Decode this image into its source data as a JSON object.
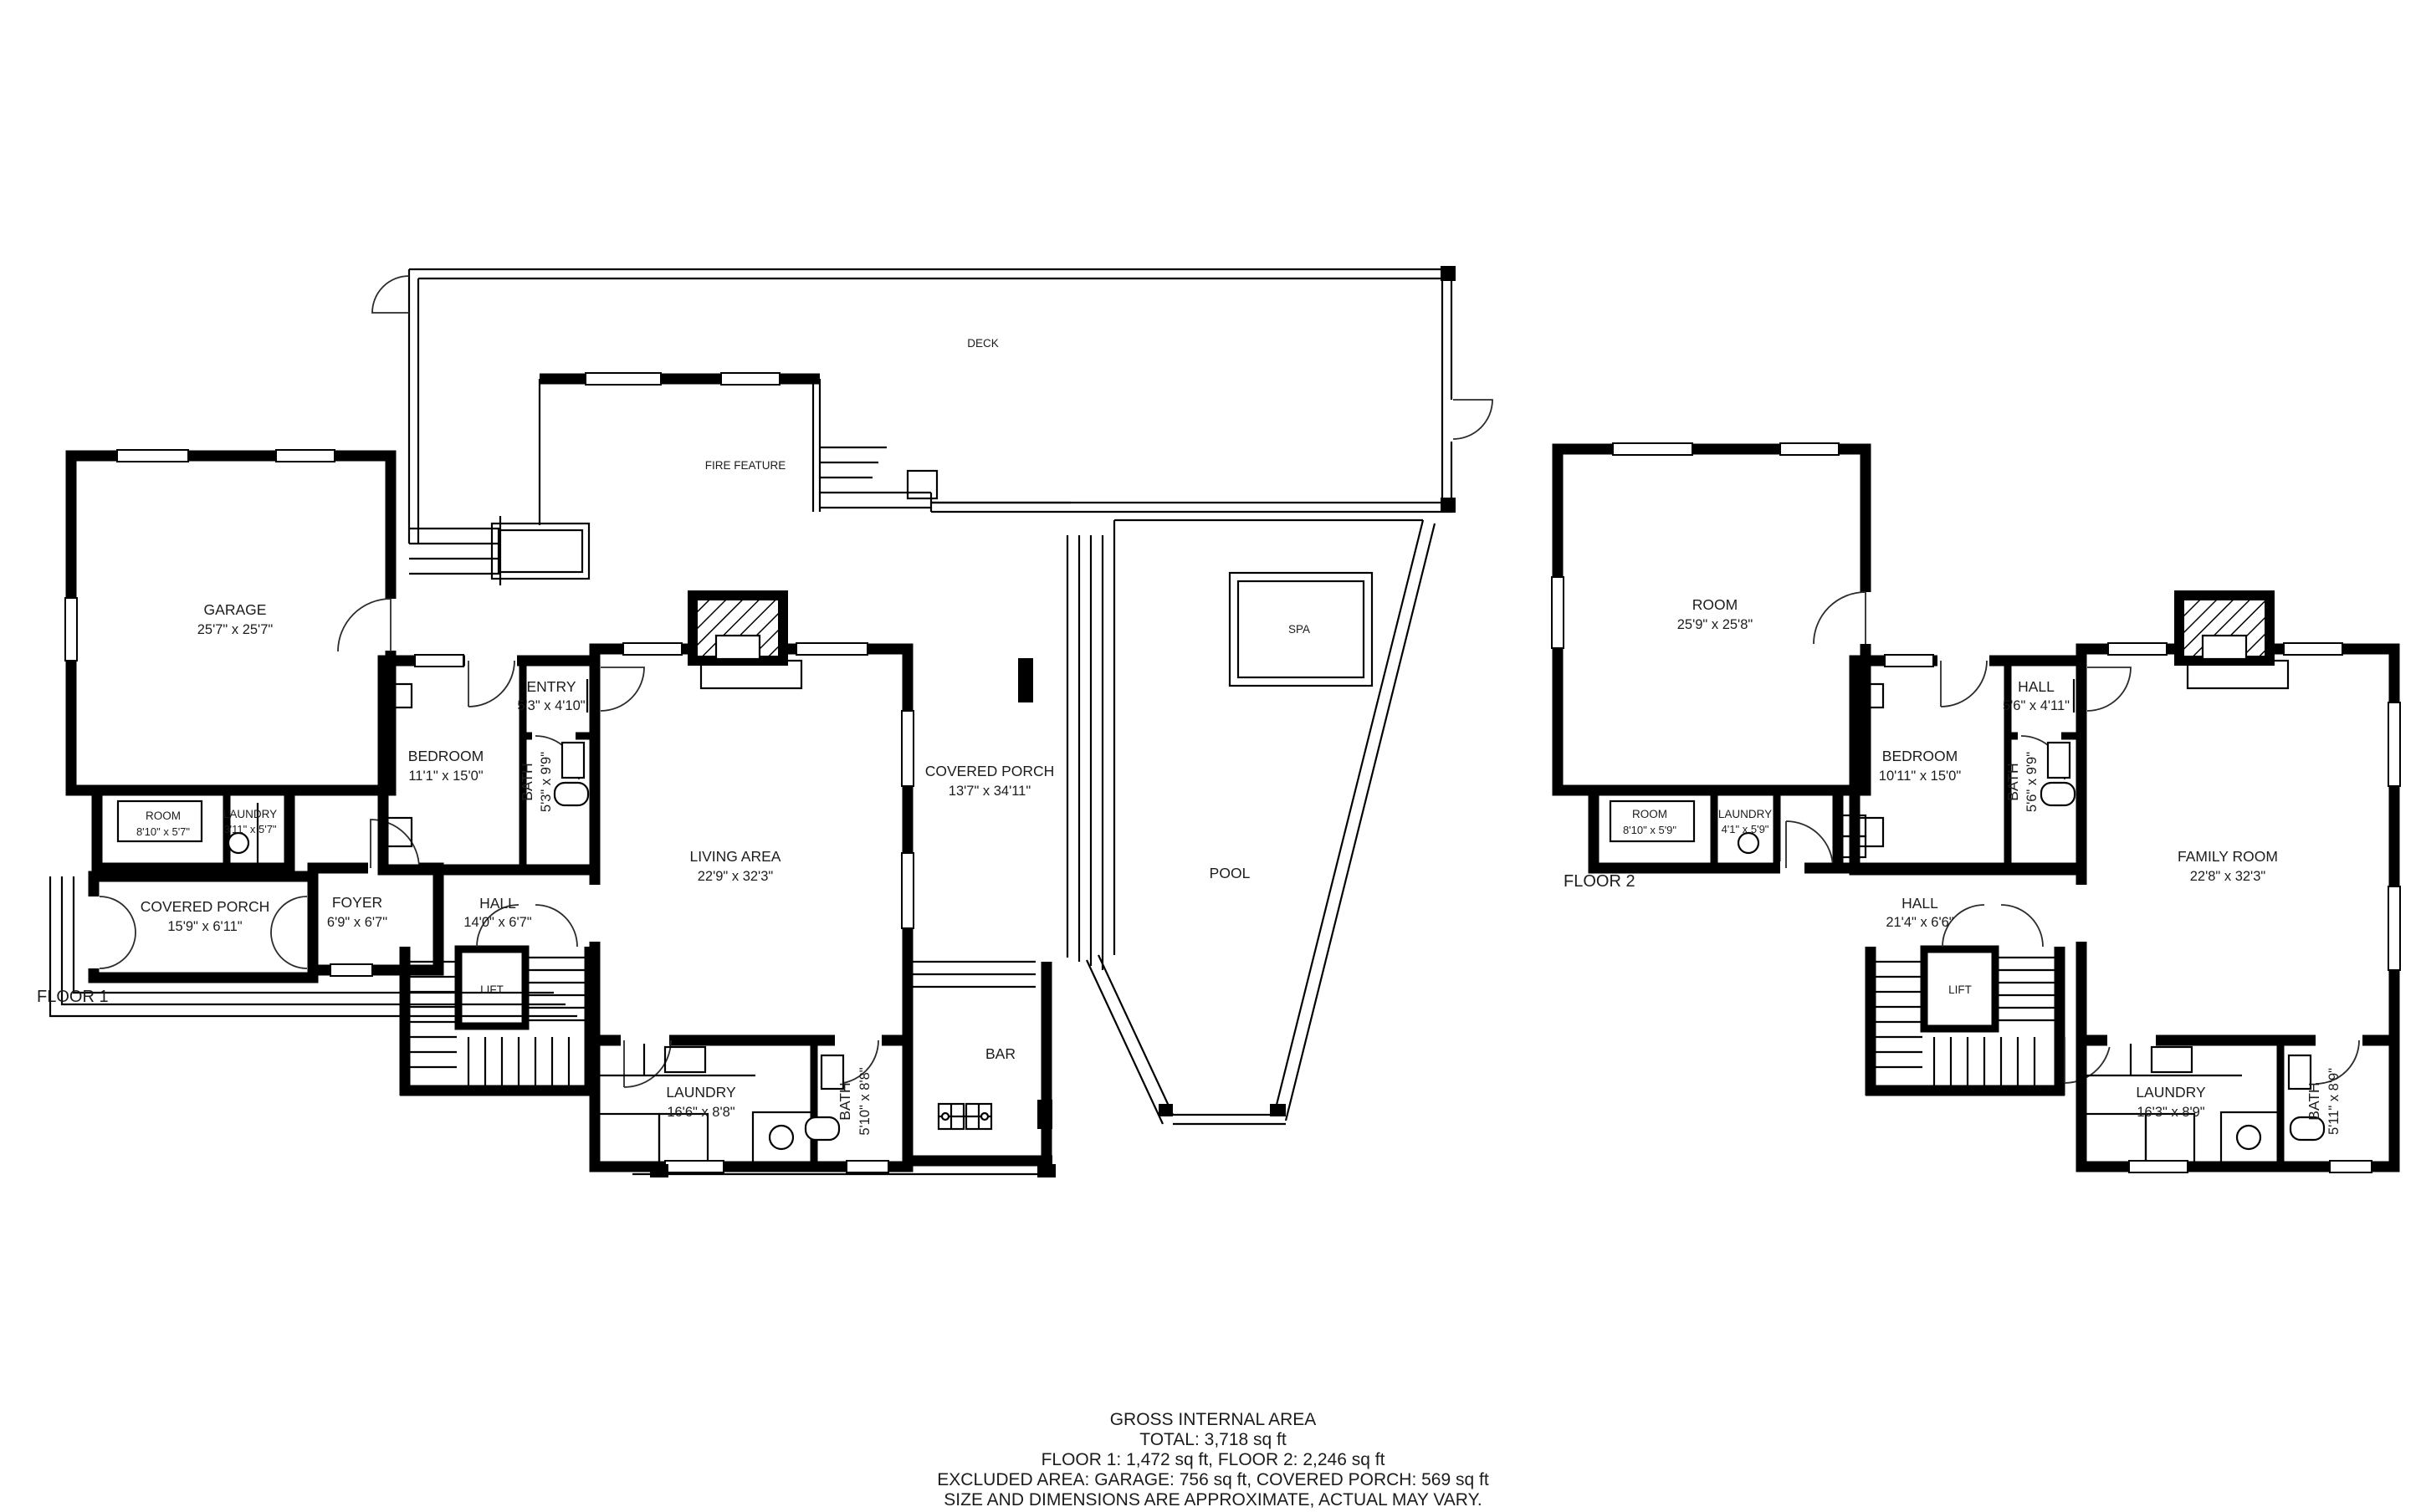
{
  "floor1": {
    "label": "FLOOR 1",
    "rooms": {
      "garage": {
        "name": "GARAGE",
        "dims": "25'7\" x 25'7\""
      },
      "room": {
        "name": "ROOM",
        "dims": "8'10\" x 5'7\""
      },
      "laundry_small": {
        "name": "LAUNDRY",
        "dims": "3'11\" x 5'7\""
      },
      "covered_porch": {
        "name": "COVERED PORCH",
        "dims": "15'9\" x 6'11\""
      },
      "foyer": {
        "name": "FOYER",
        "dims": "6'9\" x 6'7\""
      },
      "bedroom": {
        "name": "BEDROOM",
        "dims": "11'1\" x 15'0\""
      },
      "entry": {
        "name": "ENTRY",
        "dims": "5'3\" x 4'10\""
      },
      "bath": {
        "name": "BATH",
        "dims": "5'3\" x 9'9\""
      },
      "hall": {
        "name": "HALL",
        "dims": "14'0\" x 6'7\""
      },
      "lift": {
        "name": "LIFT"
      },
      "living_area": {
        "name": "LIVING AREA",
        "dims": "22'9\" x 32'3\""
      },
      "laundry": {
        "name": "LAUNDRY",
        "dims": "16'6\" x 8'8\""
      },
      "bath2": {
        "name": "BATH",
        "dims": "5'10\" x 8'8\""
      },
      "deck": {
        "name": "DECK"
      },
      "fire_feature": {
        "name": "FIRE FEATURE"
      },
      "covered_porch_rear": {
        "name": "COVERED PORCH",
        "dims": "13'7\" x 34'11\""
      },
      "spa": {
        "name": "SPA"
      },
      "pool": {
        "name": "POOL"
      },
      "bar": {
        "name": "BAR"
      }
    }
  },
  "floor2": {
    "label": "FLOOR 2",
    "rooms": {
      "room_large": {
        "name": "ROOM",
        "dims": "25'9\" x 25'8\""
      },
      "room_small": {
        "name": "ROOM",
        "dims": "8'10\" x 5'9\""
      },
      "laundry_small": {
        "name": "LAUNDRY",
        "dims": "4'1\" x 5'9\""
      },
      "bedroom": {
        "name": "BEDROOM",
        "dims": "10'11\" x 15'0\""
      },
      "hall_small": {
        "name": "HALL",
        "dims": "5'6\" x 4'11\""
      },
      "bath": {
        "name": "BATH",
        "dims": "5'6\" x 9'9\""
      },
      "family_room": {
        "name": "FAMILY ROOM",
        "dims": "22'8\" x 32'3\""
      },
      "hall": {
        "name": "HALL",
        "dims": "21'4\" x 6'6\""
      },
      "lift": {
        "name": "LIFT"
      },
      "laundry": {
        "name": "LAUNDRY",
        "dims": "16'3\" x 8'9\""
      },
      "bath2": {
        "name": "BATH",
        "dims": "5'11\" x 8'9\""
      }
    }
  },
  "summary": {
    "line1": "GROSS INTERNAL AREA",
    "line2": "TOTAL: 3,718 sq ft",
    "line3": "FLOOR 1: 1,472 sq ft, FLOOR 2: 2,246 sq ft",
    "line4": "EXCLUDED AREA: GARAGE: 756 sq ft, COVERED PORCH: 569 sq ft",
    "line5": "SIZE AND DIMENSIONS ARE APPROXIMATE, ACTUAL MAY VARY."
  },
  "colors": {
    "wall": "#000000",
    "background": "#ffffff"
  }
}
